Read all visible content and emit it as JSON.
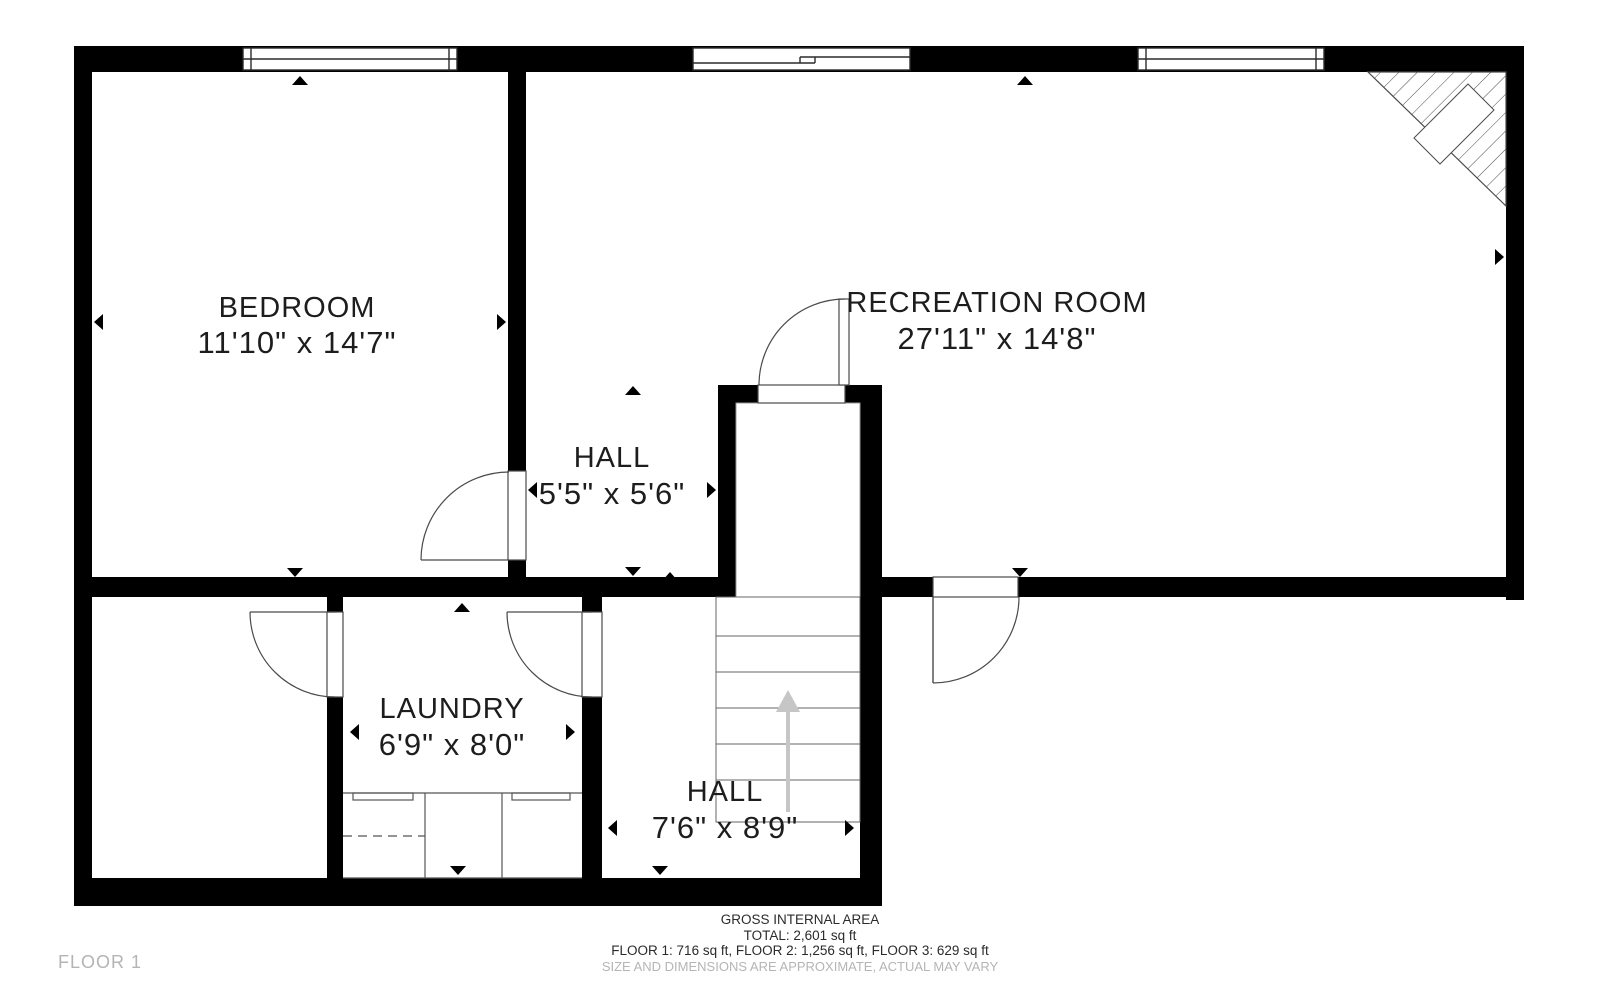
{
  "plan": {
    "floor_label": "FLOOR 1",
    "rooms": [
      {
        "name": "BEDROOM",
        "dims": "11'10\" x 14'7\""
      },
      {
        "name": "RECREATION ROOM",
        "dims": "27'11\" x 14'8\""
      },
      {
        "name": "HALL",
        "dims": "5'5\" x 5'6\""
      },
      {
        "name": "LAUNDRY",
        "dims": "6'9\" x 8'0\""
      },
      {
        "name": "HALL",
        "dims": "7'6\" x 8'9\""
      }
    ],
    "footer": {
      "line1": "GROSS INTERNAL AREA",
      "line2": "TOTAL: 2,601 sq ft",
      "line3": "FLOOR 1: 716 sq ft, FLOOR 2: 1,256 sq ft, FLOOR 3: 629 sq ft",
      "line4": "SIZE AND DIMENSIONS ARE APPROXIMATE, ACTUAL MAY VARY"
    },
    "colors": {
      "wall": "#000000",
      "label_text": "#1d1d1d",
      "muted_text": "#b5b5b5",
      "stairs_arrow": "#c6c6c6"
    }
  }
}
